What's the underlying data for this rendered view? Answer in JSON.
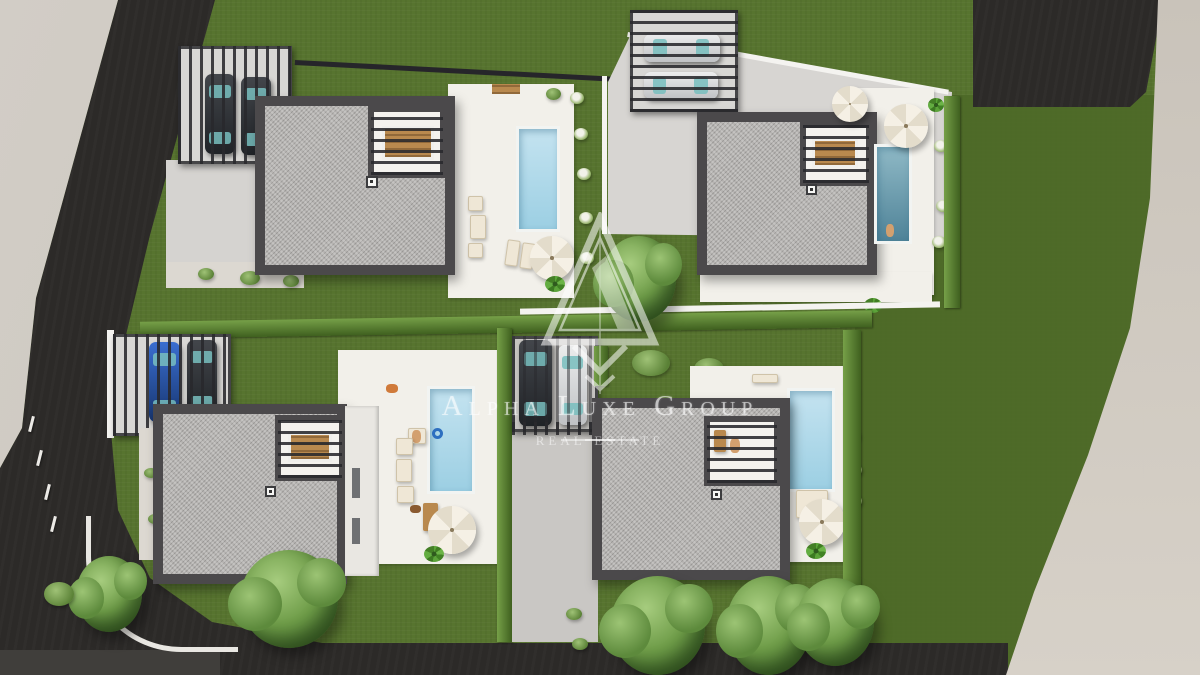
{
  "watermark": {
    "brand": "Alpha Luxe Group",
    "tagline": "real estate",
    "logo_icon": "alpha-triangle-monogram"
  },
  "scene": {
    "type": "aerial-3d-architectural-render",
    "subject": "Site plan of four modern single-family villas, each with flat gravel roof, wood-slat pergola, private pool, white sun terrace and lawn",
    "villas": 4,
    "pools": 4,
    "carports": [
      {
        "villa": "top-left",
        "cars": [
          "dark",
          "dark"
        ]
      },
      {
        "villa": "top-right",
        "cars": [
          "silver",
          "silver"
        ]
      },
      {
        "villa": "bottom-left",
        "cars": [
          "blue",
          "dark"
        ]
      },
      {
        "villa": "central-shared",
        "cars": [
          "dark",
          "silver"
        ]
      }
    ],
    "roads": [
      "diagonal asphalt road left",
      "asphalt road bottom",
      "asphalt patch top-right"
    ],
    "sidewalks": [
      "light sidewalk left",
      "beige sidewalk right"
    ]
  },
  "colors": {
    "lawn": "#57742f",
    "lawn-dark": "#4c6827",
    "road": "#2c2a28",
    "walk-left": "#c3beb7",
    "walk-right": "#d7d1c8",
    "roof-edge": "#4b494b",
    "gravel": "#b6b4b2",
    "terrace": "#f2f0ea",
    "concrete": "#d5d3d0",
    "pool": "#c4e3f0",
    "pool-deep": "#8fb9c6",
    "hedge": "#3f601f",
    "hedge-hi": "#76a048",
    "wood": "#b9894e",
    "white-wall": "#f4f3f0"
  }
}
